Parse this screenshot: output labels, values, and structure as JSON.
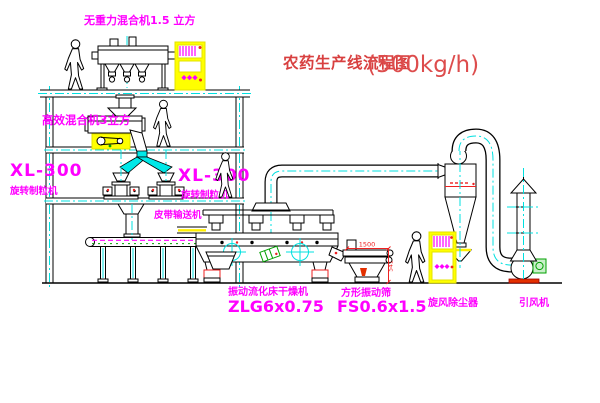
{
  "title": {
    "zh": "农药生产线流程图",
    "rate": "(500kg/h)"
  },
  "labels": {
    "top_mixer": "无重力混合机1.5 立方",
    "high_mixer": "高效混合机3立方",
    "granulator_left_model": "XL-300",
    "granulator_left_name": "旋转制粒机",
    "granulator_right_model": "XL-300",
    "granulator_right_name": "旋转制粒机",
    "belt_conveyor": "皮带输送机",
    "dryer_name": "振动流化床干燥机",
    "dryer_model": "ZLG6x0.75",
    "sieve_name": "方形振动筛",
    "sieve_model": "FS0.6x1.5",
    "cyclone": "旋风除尘器",
    "fan": "引风机"
  },
  "dimensions": {
    "sieve_width": "1500",
    "sieve_height": "541"
  },
  "colors": {
    "background": "#ffffff",
    "line": "#000000",
    "centerline_cyan": "#00e0e0",
    "label_magenta": "#ff00ff",
    "annotation_red": "#ee2222",
    "cabinet_yellow": "#ffff00",
    "motor_green": "#00a000",
    "title_red": "#d84040"
  }
}
